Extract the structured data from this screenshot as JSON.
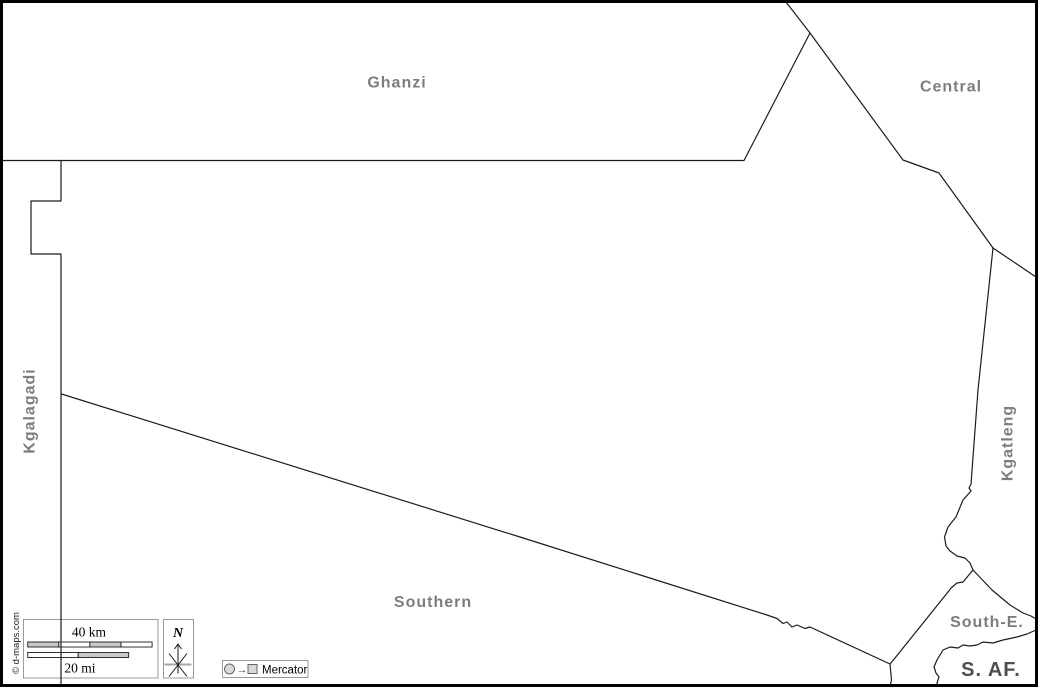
{
  "map": {
    "region_labels": {
      "ghanzi": "Ghanzi",
      "central": "Central",
      "kgalagadi": "Kgalagadi",
      "kgatleng": "Kgatleng",
      "southern": "Southern",
      "south_east": "South-E.",
      "south_africa": "S. AF."
    },
    "colors": {
      "background": "#ffffff",
      "frame": "#000000",
      "border_line": "#1c1c1c",
      "region_label": "#7d7d7d",
      "country_label": "#4f4f4f",
      "scale_bar_fill": "#c8c8c8",
      "legend_box_border": "#999999"
    }
  },
  "legend": {
    "scale": {
      "km_label": "40 km",
      "mi_label": "20 mi"
    },
    "compass": {
      "north_label": "N",
      "icon": "north-compass-star-icon"
    },
    "projection": {
      "name": "Mercator",
      "arrow_glyph": "→",
      "source_icon": "sphere-circle-icon",
      "target_icon": "flat-map-square-icon"
    }
  },
  "credits": {
    "copyright": "© d-maps.com"
  }
}
